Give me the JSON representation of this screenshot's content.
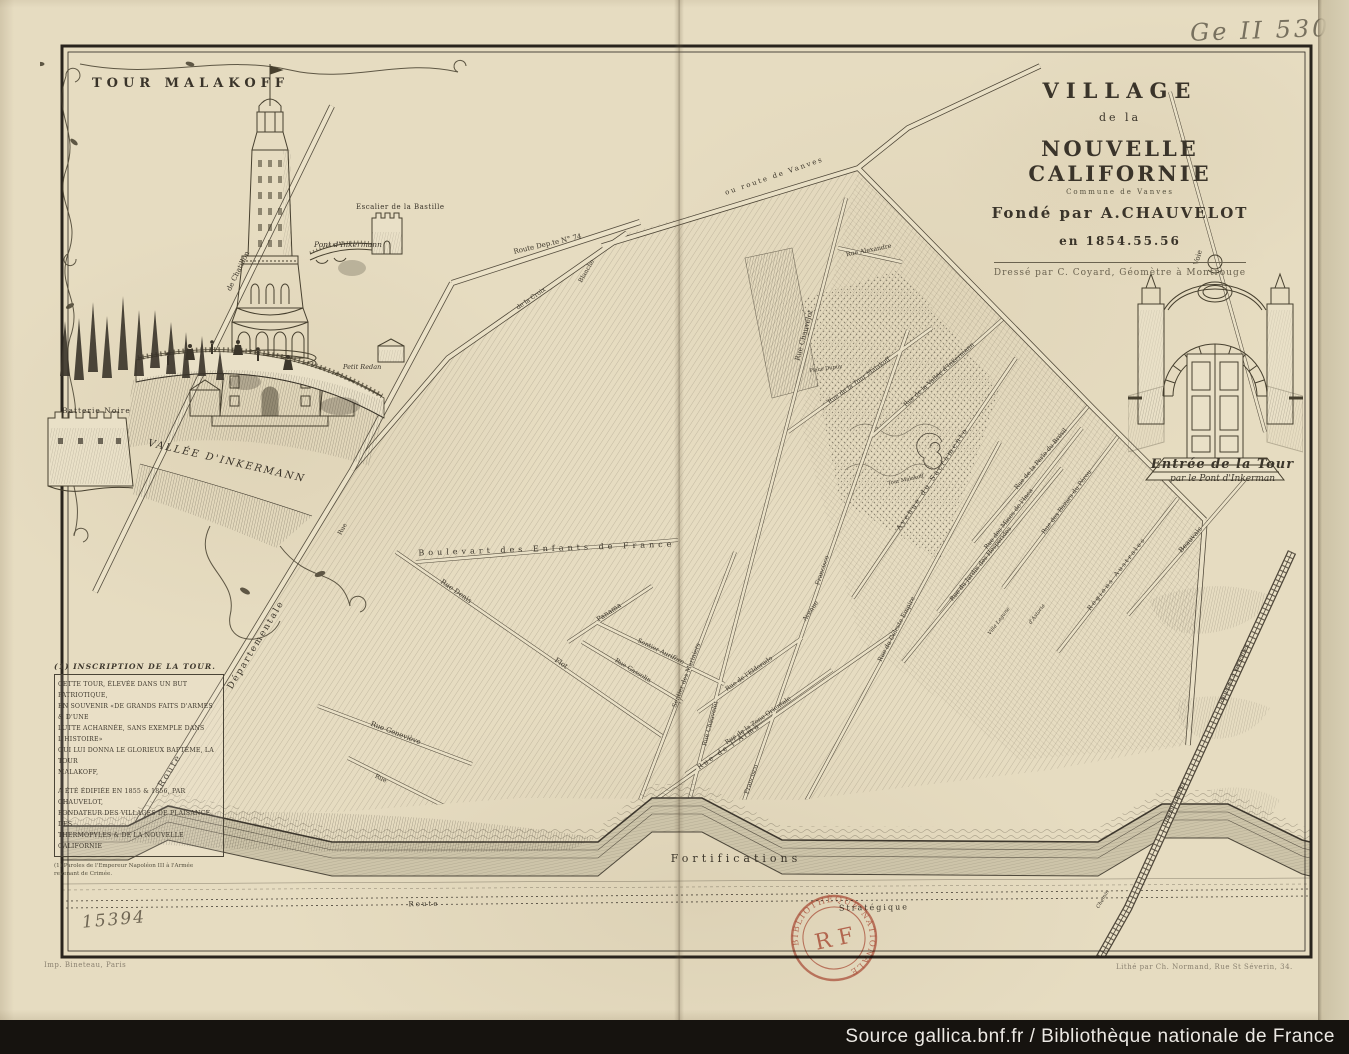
{
  "page": {
    "shelfmark": "Ge II 5307",
    "handwritten_number": "15394",
    "source_bar": "Source gallica.bnf.fr / Bibliothèque nationale de France"
  },
  "title_block": {
    "line1": "VILLAGE",
    "line2": "de la",
    "line3": "NOUVELLE CALIFORNIE",
    "line4": "Commune de Vanves",
    "line5": "Fondé par A.CHAUVELOT",
    "line6": "en 1854.55.56",
    "credit": "Dressé par C. Coyard, Géomètre à Montrouge"
  },
  "vignette_tower": {
    "title": "TOUR MALAKOFF",
    "escalier": "Escalier de la Bastille",
    "pont": "Pont d'Inkermann",
    "redan": "Petit Redan",
    "batterie": "Batterie Noire",
    "vallee": "VALLÉE D'INKERMANN"
  },
  "vignette_entree": {
    "caption_line1": "Entrée de la Tour",
    "caption_line2": "par le Pont d'Inkerman"
  },
  "inscription": {
    "heading": "(1) INSCRIPTION DE LA TOUR.",
    "lines": [
      "CETTE TOUR, ÉLEVÉE DANS UN BUT PATRIOTIQUE,",
      "EN SOUVENIR «DE GRANDS FAITS D'ARMES & D'UNE",
      "LUTTE ACHARNÉE, SANS EXEMPLE DANS L'HISTOIRE»",
      "QUI LUI DONNA LE GLORIEUX BAPTÊME, LA TOUR",
      "MALAKOFF,",
      "A ÉTÉ ÉDIFIÉE EN 1855 & 1856, PAR CHAUVELOT,",
      "FONDATEUR DES VILLAGES DE PLAISANCE, DES",
      "THERMOPYLES & DE LA NOUVELLE CALIFORNIE"
    ],
    "footnote_line1": "(1) Paroles de l'Empereur Napoléon III à l'Armée",
    "footnote_line2": "revenant de Crimée."
  },
  "imprints": {
    "left": "Imp. Bineteau, Paris",
    "right": "Lithé par Ch. Normand, Rue St Séverin, 34."
  },
  "stamp": {
    "center": "R F",
    "ring_text": "BIBLIOTHÈQUE NATIONALE",
    "color": "#b94b38"
  },
  "colors": {
    "paper": "#e6dcc1",
    "ink": "#3c362b",
    "stamp_red": "#b94b38",
    "bar_bg": "#16130f",
    "bar_text": "#ece9e4"
  },
  "map": {
    "labels": [
      {
        "text": "ou route de Vanves"
      },
      {
        "text": "Voie"
      },
      {
        "text": "de Chatillon"
      },
      {
        "text": "Route Dep.te N° 74"
      },
      {
        "text": "Route"
      },
      {
        "text": "Départementale"
      },
      {
        "text": "Rue Chauvelot"
      },
      {
        "text": "Rue Alexandre"
      },
      {
        "text": "Rue de la Tour Malakoff"
      },
      {
        "text": "Rue de la Vallée d'Inkermann"
      },
      {
        "text": "Place Dupuy"
      },
      {
        "text": "Avenue du Sacramento"
      },
      {
        "text": "Rue de la Perle du Brésil"
      },
      {
        "text": "Rue des Bazars du Pérou"
      },
      {
        "text": "Rue des Mines de l'Inca"
      },
      {
        "text": "Rue du Jardin des Hespérides"
      },
      {
        "text": "Régions Australes"
      },
      {
        "text": "Beauvais"
      },
      {
        "text": "Rue du Céleste Empire"
      },
      {
        "text": "Rue de l'Eldorado"
      },
      {
        "text": "Rue de la Zone Orientale"
      },
      {
        "text": "Rue de l'Alma"
      },
      {
        "text": "Sentier des Mariniers"
      },
      {
        "text": "Sentier Aurifère"
      },
      {
        "text": "Rue Gassolin"
      },
      {
        "text": "Panama"
      },
      {
        "text": "Boulevart des Enfants de France"
      },
      {
        "text": "Rue Denis"
      },
      {
        "text": "Flot"
      },
      {
        "text": "Rue Geneviève"
      },
      {
        "text": "Francisco"
      },
      {
        "text": "Francisco"
      },
      {
        "text": "Tour Malakoff"
      },
      {
        "text": "Villa Lagune"
      },
      {
        "text": "d'Astoria"
      },
      {
        "text": "de Paris à Versailles"
      },
      {
        "text": "Chemin de Fer"
      },
      {
        "text": "Chemin"
      },
      {
        "text": "Fortifications"
      },
      {
        "text": "Route"
      },
      {
        "text": "Stratégique"
      },
      {
        "text": "Rue"
      },
      {
        "text": "Rue"
      },
      {
        "text": "Blanche"
      },
      {
        "text": "de la Croix"
      },
      {
        "text": "Rue Chauvelot"
      },
      {
        "text": "Avenue"
      }
    ]
  }
}
